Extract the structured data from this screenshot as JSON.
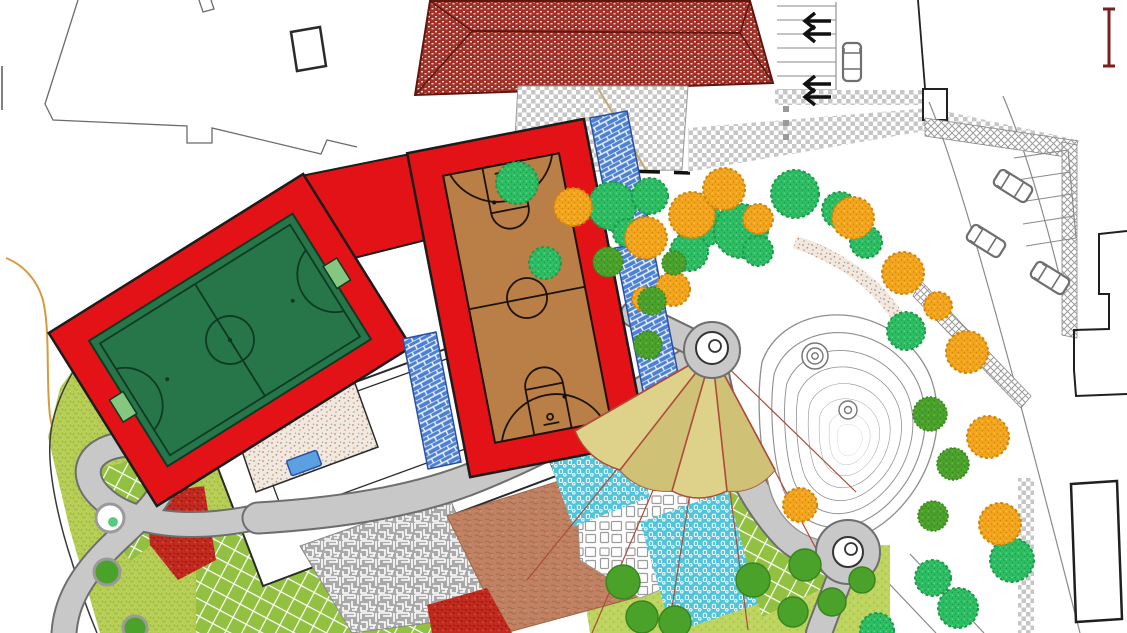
{
  "meta": {
    "domain": "landscape-site-plan",
    "description": "Colored master plan of a park: sports pitches, building with tiled roof, parking, paths, play surfaces and planting"
  },
  "palette": {
    "white": "#ffffff",
    "outline": "#1c1c1c",
    "plotLine": "#6f6f6f",
    "roofRed": "#a23227",
    "roofEdge": "#5f160f",
    "checkerGray": "#c6c6c6",
    "frameRed": "#e31217",
    "pitchGreen": "#27764a",
    "pitchLine": "#0e3a22",
    "goalGreen": "#85c77f",
    "courtBrown": "#b97f46",
    "courtLine": "#1c1208",
    "standsBlue": "#4b80d2",
    "standsLine": "#2a4fa2",
    "pathGray": "#c8c8c8",
    "pathEdge": "#6e6e6e",
    "lawnLight": "#b6ce55",
    "lawnSpeck": "#90ab33",
    "gridGreen": "#92c040",
    "dotLawn": "#bdd55f",
    "treeGreen": "#2dbd62",
    "treeGreenDark": "#1d9a4b",
    "treeOrange": "#f3a51d",
    "treeOrangeDark": "#d08508",
    "treeMedium": "#4aa22b",
    "treeMediumDark": "#39851d",
    "teal": "#52c3d9",
    "terracotta": "#c08262",
    "terracottaDark": "#a16746",
    "mazeGray": "#a9a9a9",
    "redGround": "#c22a1f",
    "redGroundDark": "#8c150d",
    "sandBase": "#f1e9e0",
    "sandDot": "#b98f77",
    "umbCanopy": "#ded28a",
    "umbCanopyDark": "#cdbf72",
    "umbRib": "#ad4a3b",
    "contourGray": "#8f8f8f",
    "boundaryOrange": "#d79a3f",
    "carGray": "#6f6f6f",
    "benchBlue": "#5ba0e0",
    "scaleBarRed": "#7a1f1f"
  },
  "features": {
    "building_roof": {
      "type": "hipped-red-tile-roof"
    },
    "entry_plaza": {
      "type": "checkered-paving"
    },
    "parking_north": {
      "stall_rows": 7,
      "arrow_pairs": 2
    },
    "road_east": {
      "stalls": 5
    },
    "football_pitch": {
      "goals": 2,
      "rotation_deg": -32
    },
    "basketball_court": {
      "hoops": 2,
      "rotation_deg": -11
    },
    "grandstand_steps": {
      "strips": 3
    },
    "shade_umbrella": {
      "sectors": 4,
      "ribs": 5,
      "guy_lines": 6
    },
    "contour_mound": {
      "contour_lines": 8
    },
    "path_nodes": 2,
    "play_surfaces": [
      "maze-court",
      "terracotta-court",
      "red-court",
      "teal-court",
      "crazy-paving",
      "grass-lattice",
      "sand-area"
    ],
    "trees": {
      "fluffy_green": [
        [
          517,
          183,
          21
        ],
        [
          612,
          206,
          24
        ],
        [
          650,
          196,
          18
        ],
        [
          700,
          224,
          24
        ],
        [
          741,
          231,
          27
        ],
        [
          795,
          194,
          24
        ],
        [
          840,
          210,
          18
        ],
        [
          866,
          242,
          16
        ],
        [
          906,
          331,
          19
        ],
        [
          545,
          263,
          16
        ],
        [
          689,
          252,
          19
        ],
        [
          627,
          233,
          14
        ],
        [
          758,
          251,
          15
        ],
        [
          1012,
          560,
          22
        ],
        [
          958,
          608,
          20
        ],
        [
          933,
          578,
          18
        ],
        [
          877,
          630,
          17
        ]
      ],
      "fluffy_orange": [
        [
          573,
          207,
          19
        ],
        [
          646,
          238,
          21
        ],
        [
          692,
          215,
          23
        ],
        [
          724,
          189,
          21
        ],
        [
          758,
          219,
          15
        ],
        [
          673,
          289,
          17
        ],
        [
          644,
          299,
          12
        ],
        [
          853,
          218,
          21
        ],
        [
          903,
          273,
          21
        ],
        [
          938,
          306,
          14
        ],
        [
          967,
          352,
          21
        ],
        [
          988,
          437,
          21
        ],
        [
          1000,
          524,
          21
        ],
        [
          800,
          505,
          17
        ]
      ],
      "round_green": [
        [
          608,
          262,
          15
        ],
        [
          652,
          301,
          14
        ],
        [
          648,
          345,
          14
        ],
        [
          674,
          263,
          12
        ],
        [
          930,
          414,
          17
        ],
        [
          953,
          464,
          16
        ],
        [
          933,
          516,
          15
        ]
      ],
      "lawn_plain_green": [
        [
          623,
          582,
          17
        ],
        [
          642,
          617,
          16
        ],
        [
          675,
          622,
          16
        ],
        [
          753,
          580,
          17
        ],
        [
          805,
          565,
          16
        ],
        [
          793,
          612,
          15
        ],
        [
          832,
          602,
          14
        ],
        [
          862,
          580,
          13
        ]
      ],
      "lawn_green_ringed": [
        [
          107,
          572,
          13
        ],
        [
          135,
          628,
          12
        ]
      ],
      "lawn_white": [
        [
          110,
          518,
          14
        ]
      ]
    },
    "cars": [
      {
        "x": 852,
        "y": 62,
        "rot": 0
      },
      {
        "x": 1013,
        "y": 186,
        "rot": -58
      },
      {
        "x": 986,
        "y": 241,
        "rot": -58
      },
      {
        "x": 1050,
        "y": 278,
        "rot": -58
      }
    ]
  }
}
